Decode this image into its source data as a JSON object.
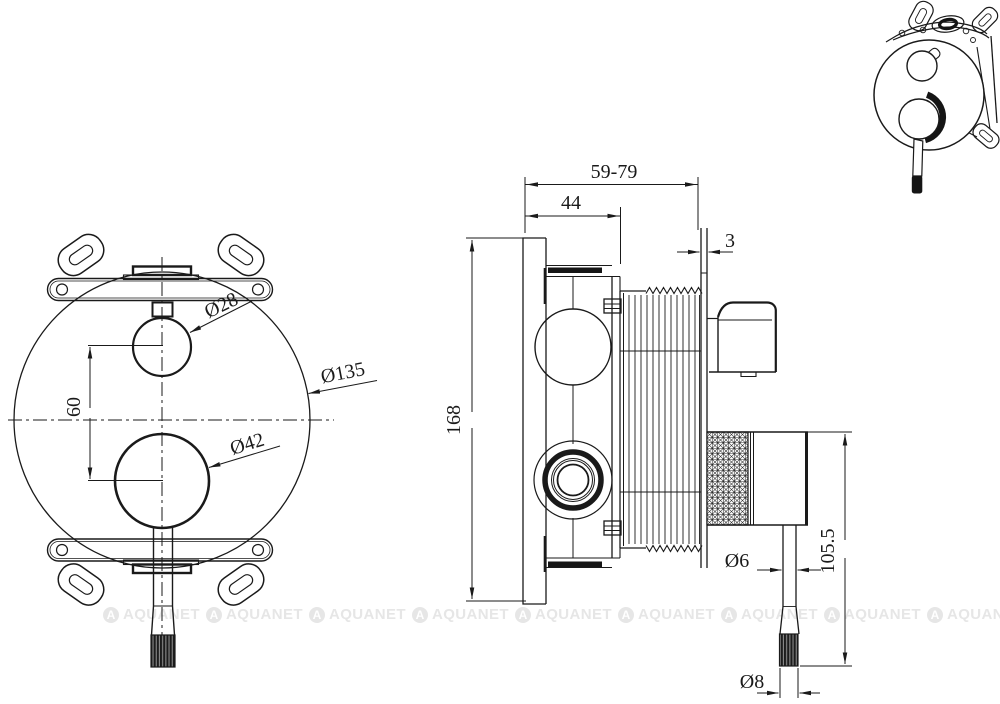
{
  "drawing": {
    "background": "#ffffff",
    "line_color": "#1a1a1a",
    "front_view": {
      "dim_center_spacing": "60",
      "dim_small_knob_diameter": "Ø28",
      "dim_large_knob_diameter": "Ø42",
      "dim_plate_diameter": "Ø135"
    },
    "side_view": {
      "dim_depth_range": "59-79",
      "dim_body_depth": "44",
      "dim_plate_thickness": "3",
      "dim_height": "168",
      "dim_handle_rod_diameter": "Ø6",
      "dim_handle_tip_diameter": "Ø8",
      "dim_handle_length": "105.5"
    }
  },
  "watermark": {
    "text": "AQUANET",
    "icon_letter": "A",
    "color": "#e6e6e6"
  }
}
